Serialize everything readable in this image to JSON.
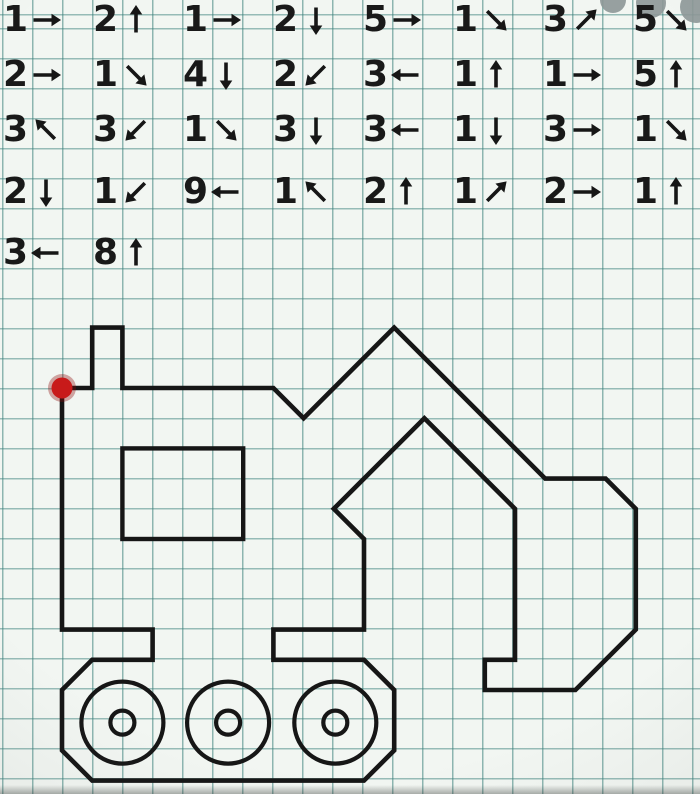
{
  "worksheet": {
    "type": "graphic-dictation",
    "subject": "excavator outline on squared paper"
  },
  "colors": {
    "paper": "#f2f6f2",
    "grid_line": "rgba(58,128,123,0.55)",
    "ink": "#161616",
    "start_dot": "#c81a1a",
    "start_dot_halo": "rgba(140,10,10,0.35)",
    "watermark_gray": "#8d9797"
  },
  "instructions": {
    "row_centers_y": [
      20,
      75,
      130,
      192,
      253
    ],
    "col_start_x": 3,
    "col_pitch": 90,
    "rows": [
      [
        {
          "n": "1",
          "dir": "E",
          "arrow": "→"
        },
        {
          "n": "2",
          "dir": "N",
          "arrow": "↑"
        },
        {
          "n": "1",
          "dir": "E",
          "arrow": "→"
        },
        {
          "n": "2",
          "dir": "S",
          "arrow": "↓"
        },
        {
          "n": "5",
          "dir": "E",
          "arrow": "→"
        },
        {
          "n": "1",
          "dir": "SE",
          "arrow": "↘"
        },
        {
          "n": "3",
          "dir": "NE",
          "arrow": "↗"
        },
        {
          "n": "5",
          "dir": "SE",
          "arrow": "↘"
        }
      ],
      [
        {
          "n": "2",
          "dir": "E",
          "arrow": "→"
        },
        {
          "n": "1",
          "dir": "SE",
          "arrow": "↘"
        },
        {
          "n": "4",
          "dir": "S",
          "arrow": "↓"
        },
        {
          "n": "2",
          "dir": "SW",
          "arrow": "↙"
        },
        {
          "n": "3",
          "dir": "W",
          "arrow": "←"
        },
        {
          "n": "1",
          "dir": "N",
          "arrow": "↑"
        },
        {
          "n": "1",
          "dir": "E",
          "arrow": "→"
        },
        {
          "n": "5",
          "dir": "N",
          "arrow": "↑"
        }
      ],
      [
        {
          "n": "3",
          "dir": "NW",
          "arrow": "↖"
        },
        {
          "n": "3",
          "dir": "SW",
          "arrow": "↙"
        },
        {
          "n": "1",
          "dir": "SE",
          "arrow": "↘"
        },
        {
          "n": "3",
          "dir": "S",
          "arrow": "↓"
        },
        {
          "n": "3",
          "dir": "W",
          "arrow": "←"
        },
        {
          "n": "1",
          "dir": "S",
          "arrow": "↓"
        },
        {
          "n": "3",
          "dir": "E",
          "arrow": "→"
        },
        {
          "n": "1",
          "dir": "SE",
          "arrow": "↘"
        }
      ],
      [
        {
          "n": "2",
          "dir": "S",
          "arrow": "↓"
        },
        {
          "n": "1",
          "dir": "SW",
          "arrow": "↙"
        },
        {
          "n": "9",
          "dir": "W",
          "arrow": "←"
        },
        {
          "n": "1",
          "dir": "NW",
          "arrow": "↖"
        },
        {
          "n": "2",
          "dir": "N",
          "arrow": "↑"
        },
        {
          "n": "1",
          "dir": "NE",
          "arrow": "↗"
        },
        {
          "n": "2",
          "dir": "E",
          "arrow": "→"
        },
        {
          "n": "1",
          "dir": "N",
          "arrow": "↑"
        }
      ],
      [
        {
          "n": "3",
          "dir": "W",
          "arrow": "←"
        },
        {
          "n": "8",
          "dir": "N",
          "arrow": "↑"
        }
      ]
    ]
  },
  "figure": {
    "origin_x": 62,
    "origin_y": 388,
    "cell": 30.2,
    "stroke_width": 4.6,
    "outline": [
      [
        0,
        0
      ],
      [
        1,
        0
      ],
      [
        1,
        -2
      ],
      [
        2,
        -2
      ],
      [
        2,
        0
      ],
      [
        7,
        0
      ],
      [
        8,
        1
      ],
      [
        11,
        -2
      ],
      [
        16,
        3
      ],
      [
        18,
        3
      ],
      [
        19,
        4
      ],
      [
        19,
        8
      ],
      [
        17,
        10
      ],
      [
        14,
        10
      ],
      [
        14,
        9
      ],
      [
        15,
        9
      ],
      [
        15,
        4
      ],
      [
        12,
        1
      ],
      [
        9,
        4
      ],
      [
        10,
        5
      ],
      [
        10,
        8
      ],
      [
        7,
        8
      ],
      [
        7,
        9
      ],
      [
        10,
        9
      ],
      [
        11,
        10
      ],
      [
        11,
        12
      ],
      [
        10,
        13
      ],
      [
        1,
        13
      ],
      [
        0,
        12
      ],
      [
        0,
        10
      ],
      [
        1,
        9
      ],
      [
        3,
        9
      ],
      [
        3,
        8
      ],
      [
        0,
        8
      ]
    ],
    "window": {
      "x": 2,
      "y": 2,
      "w": 4,
      "h": 3
    },
    "wheels": {
      "centers": [
        [
          2.0,
          11.08
        ],
        [
          5.5,
          11.08
        ],
        [
          9.05,
          11.08
        ]
      ],
      "outer_r_px": 41,
      "inner_r_px": 12,
      "stroke_width": 4.2
    },
    "start_dot": {
      "x": 0,
      "y": 0,
      "r": 10.5,
      "halo_r": 14
    }
  },
  "watermark": {
    "circles": [
      [
        613,
        0,
        13
      ],
      [
        651,
        3,
        15
      ],
      [
        696,
        7,
        16
      ]
    ]
  }
}
